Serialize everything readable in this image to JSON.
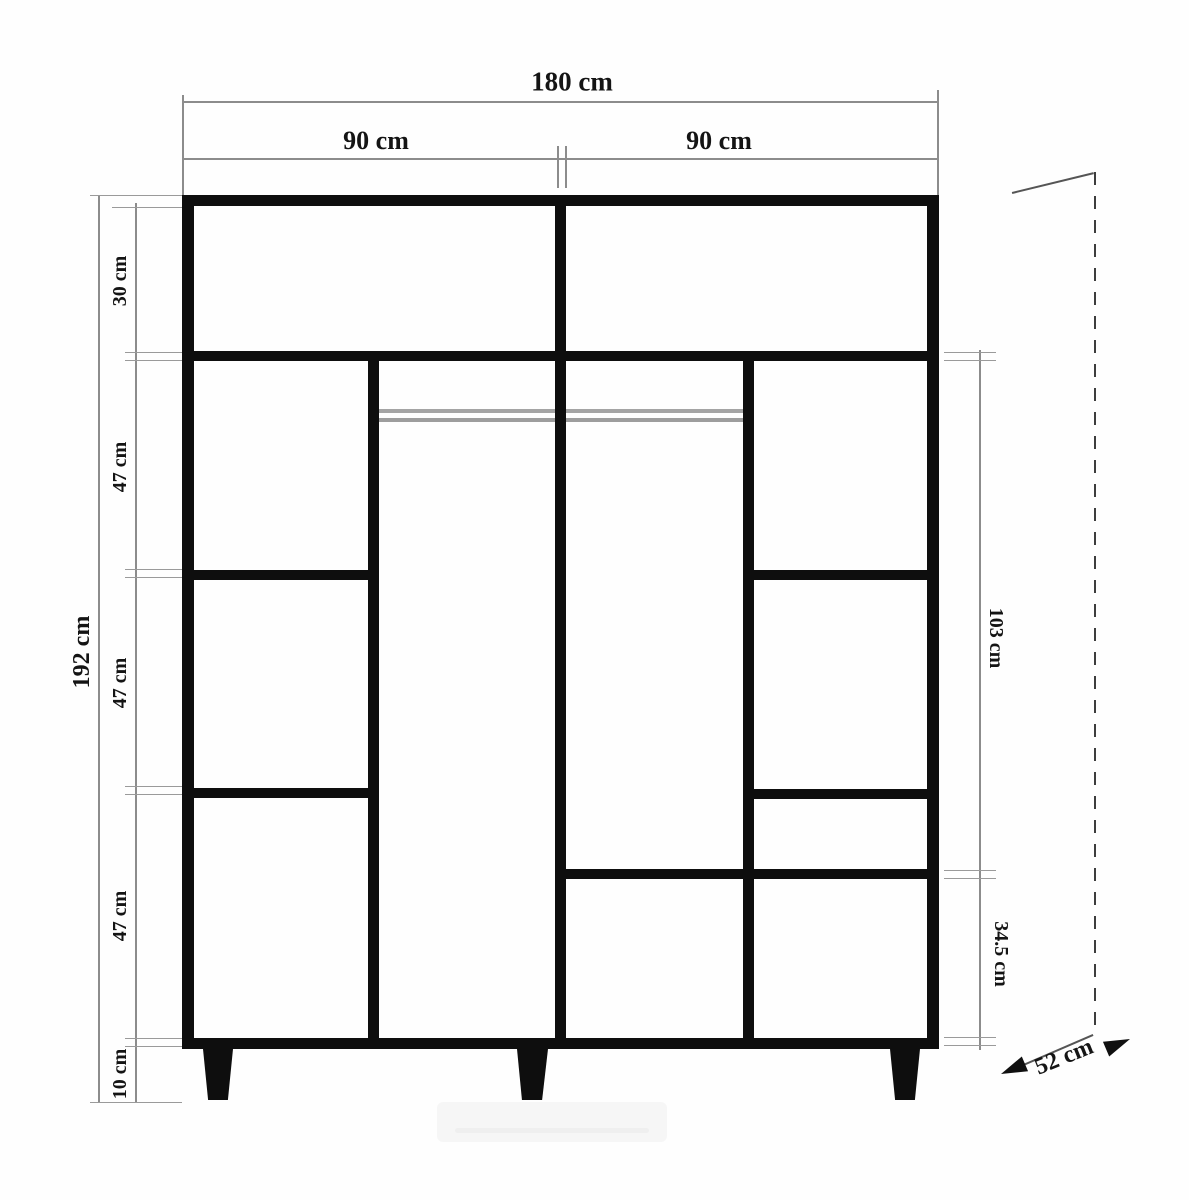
{
  "diagram": {
    "title": "wardrobe-dimension-drawing",
    "labels": {
      "total_width": "180 cm",
      "left_half_width": "90 cm",
      "right_half_width": "90 cm",
      "total_height": "192 cm",
      "sections": [
        "30 cm",
        "47 cm",
        "47 cm",
        "47 cm",
        "10 cm"
      ],
      "right_upper": "103 cm",
      "right_lower": "34.5 cm",
      "depth": "52 cm"
    },
    "colors": {
      "structure": "#0e0e0e",
      "dimension_line": "#8c8c8c",
      "rod": "#a4a4a4",
      "dashed_depth_line": "#3d3d3d",
      "background": "#fefefe"
    }
  }
}
